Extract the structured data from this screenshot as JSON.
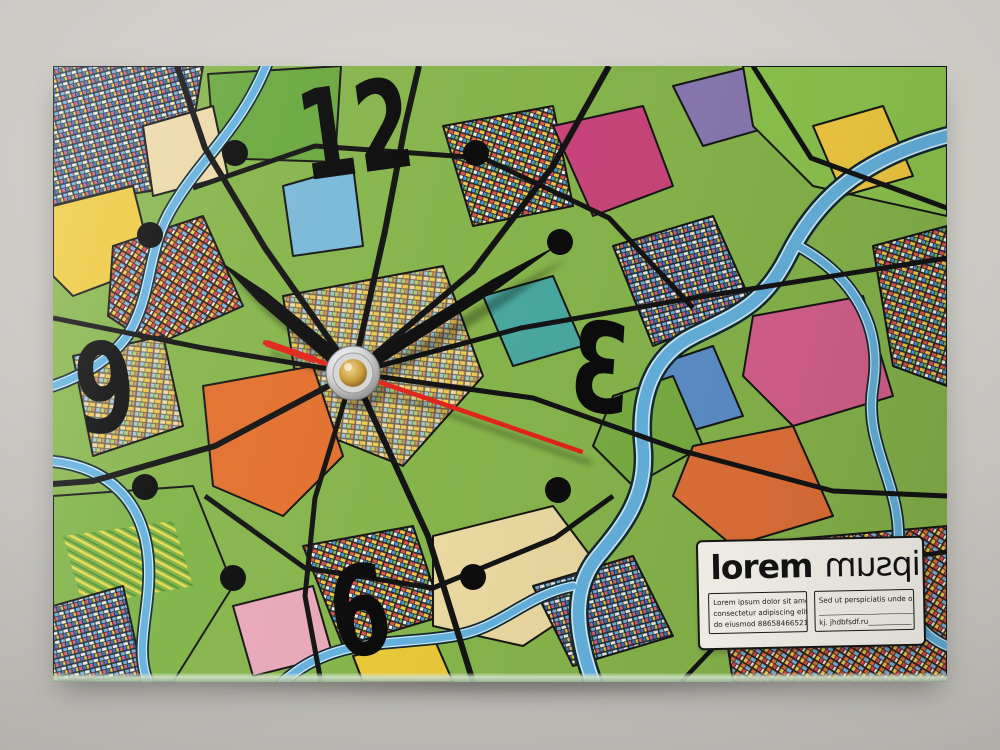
{
  "scene": {
    "subject": "rectangular glass desk clock printed with a colorful abstract city map",
    "backdrop_color": "#cccac5",
    "floor_shadow_color": "#3c3a36"
  },
  "clock": {
    "numerals": {
      "twelve": "12",
      "three": "3",
      "six": "6",
      "nine": "9"
    },
    "mirrored_numeral": "3",
    "hour_dots_at": [
      "1",
      "2",
      "4",
      "5",
      "7",
      "8",
      "10",
      "11"
    ],
    "time_reading": "about 10:10, second hand near 18 s",
    "hand_angles_deg": {
      "hour": 310,
      "minute": 58,
      "second": 109
    },
    "colors": {
      "numeral": "#0c0c0c",
      "hour_dot": "#0d0d0d",
      "hour_hand": "#101010",
      "minute_hand": "#101010",
      "second_hand": "#e1251b",
      "hub_outer_silver": "#c7c7c7",
      "hub_inner_gold": "#c79a3a"
    }
  },
  "label": {
    "title_bold": "lorem",
    "title_light": "ipsum",
    "title_light_mirrored": true,
    "left_box_lines": [
      "Lorem ipsum dolor sit amet,",
      "consectetur adipiscing elit, sed",
      "do eiusmod 88658466521 ///"
    ],
    "right_box_lines": [
      "Sed ut perspiciatis unde omnis",
      "____________________________88",
      "kj. jhdbfsdf.ru____________ ."
    ]
  },
  "map_palette": {
    "base_green": "#86b44b",
    "greens": [
      "#7fb347",
      "#8cc34d",
      "#6aa83e"
    ],
    "water_blue": "#64b1dd",
    "road_black": "#141414",
    "orange": "#e2702e",
    "yellow": "#eec93f",
    "magenta_pink": "#d4608c",
    "tan_cream": "#ead9a0",
    "light_blue": "#7ab8d8",
    "teal": "#4aa8a0",
    "purple": "#8878b0"
  }
}
